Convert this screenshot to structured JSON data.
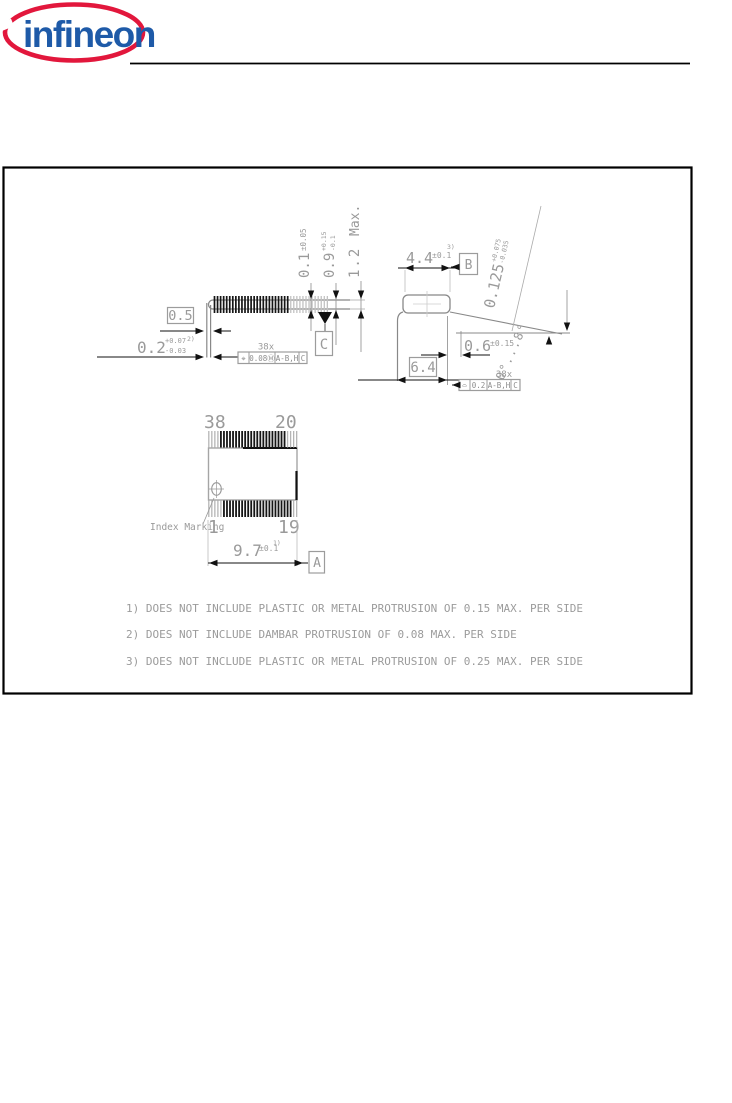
{
  "logo": {
    "text": "infineon",
    "red": "#E2173C",
    "blue": "#1E5AA8"
  },
  "colors": {
    "frame_line": "#000000",
    "dimension_gray": "#9a9a9a",
    "dark_line": "#111111"
  },
  "drawing": {
    "side_view": {
      "standoff": {
        "value": "0.1",
        "tol": "±0.05"
      },
      "body_thickness": {
        "value": "0.9",
        "tol_plus": "+0.15",
        "tol_minus": "-0.1"
      },
      "total_height": {
        "value": "1.2",
        "suffix": "Max."
      },
      "lead_width": {
        "value": "0.5"
      },
      "lead_thickness": {
        "value": "0.2",
        "tol_plus": "+0.07",
        "tol_minus": "-0.03",
        "note_ref": "2)"
      },
      "lead_count": "38x",
      "fcf": {
        "cells": [
          "⌖",
          "0.08Ⓜ",
          "A-B,H",
          "C"
        ]
      },
      "datum_c": "C"
    },
    "end_view": {
      "body_width": {
        "value": "4.4",
        "tol": "±0.1",
        "note_ref": "3)"
      },
      "datum_b": "B",
      "lead_thickness": {
        "value": "0.125",
        "tol_plus": "+0.075",
        "tol_minus": "-0.035"
      },
      "foot_length": {
        "value": "0.6",
        "tol": "±0.15"
      },
      "overall_width": {
        "value": "6.4"
      },
      "lead_angle": "0°...8°",
      "lead_count": "38x",
      "fcf": {
        "cells": [
          "⌓",
          "0.2",
          "A-B,H",
          "C"
        ]
      }
    },
    "top_view": {
      "pin_top_left": "38",
      "pin_top_right": "20",
      "pin_bottom_left": "1",
      "pin_bottom_right": "19",
      "index_marking": "Index Marking",
      "body_length": {
        "value": "9.7",
        "tol": "±0.1",
        "note_ref": "1)"
      },
      "datum_a": "A"
    },
    "notes": [
      "1) DOES NOT INCLUDE PLASTIC OR METAL PROTRUSION OF 0.15 MAX. PER SIDE",
      "2) DOES NOT INCLUDE DAMBAR PROTRUSION OF 0.08 MAX. PER SIDE",
      "3) DOES NOT INCLUDE PLASTIC OR METAL PROTRUSION OF 0.25 MAX. PER SIDE"
    ]
  }
}
